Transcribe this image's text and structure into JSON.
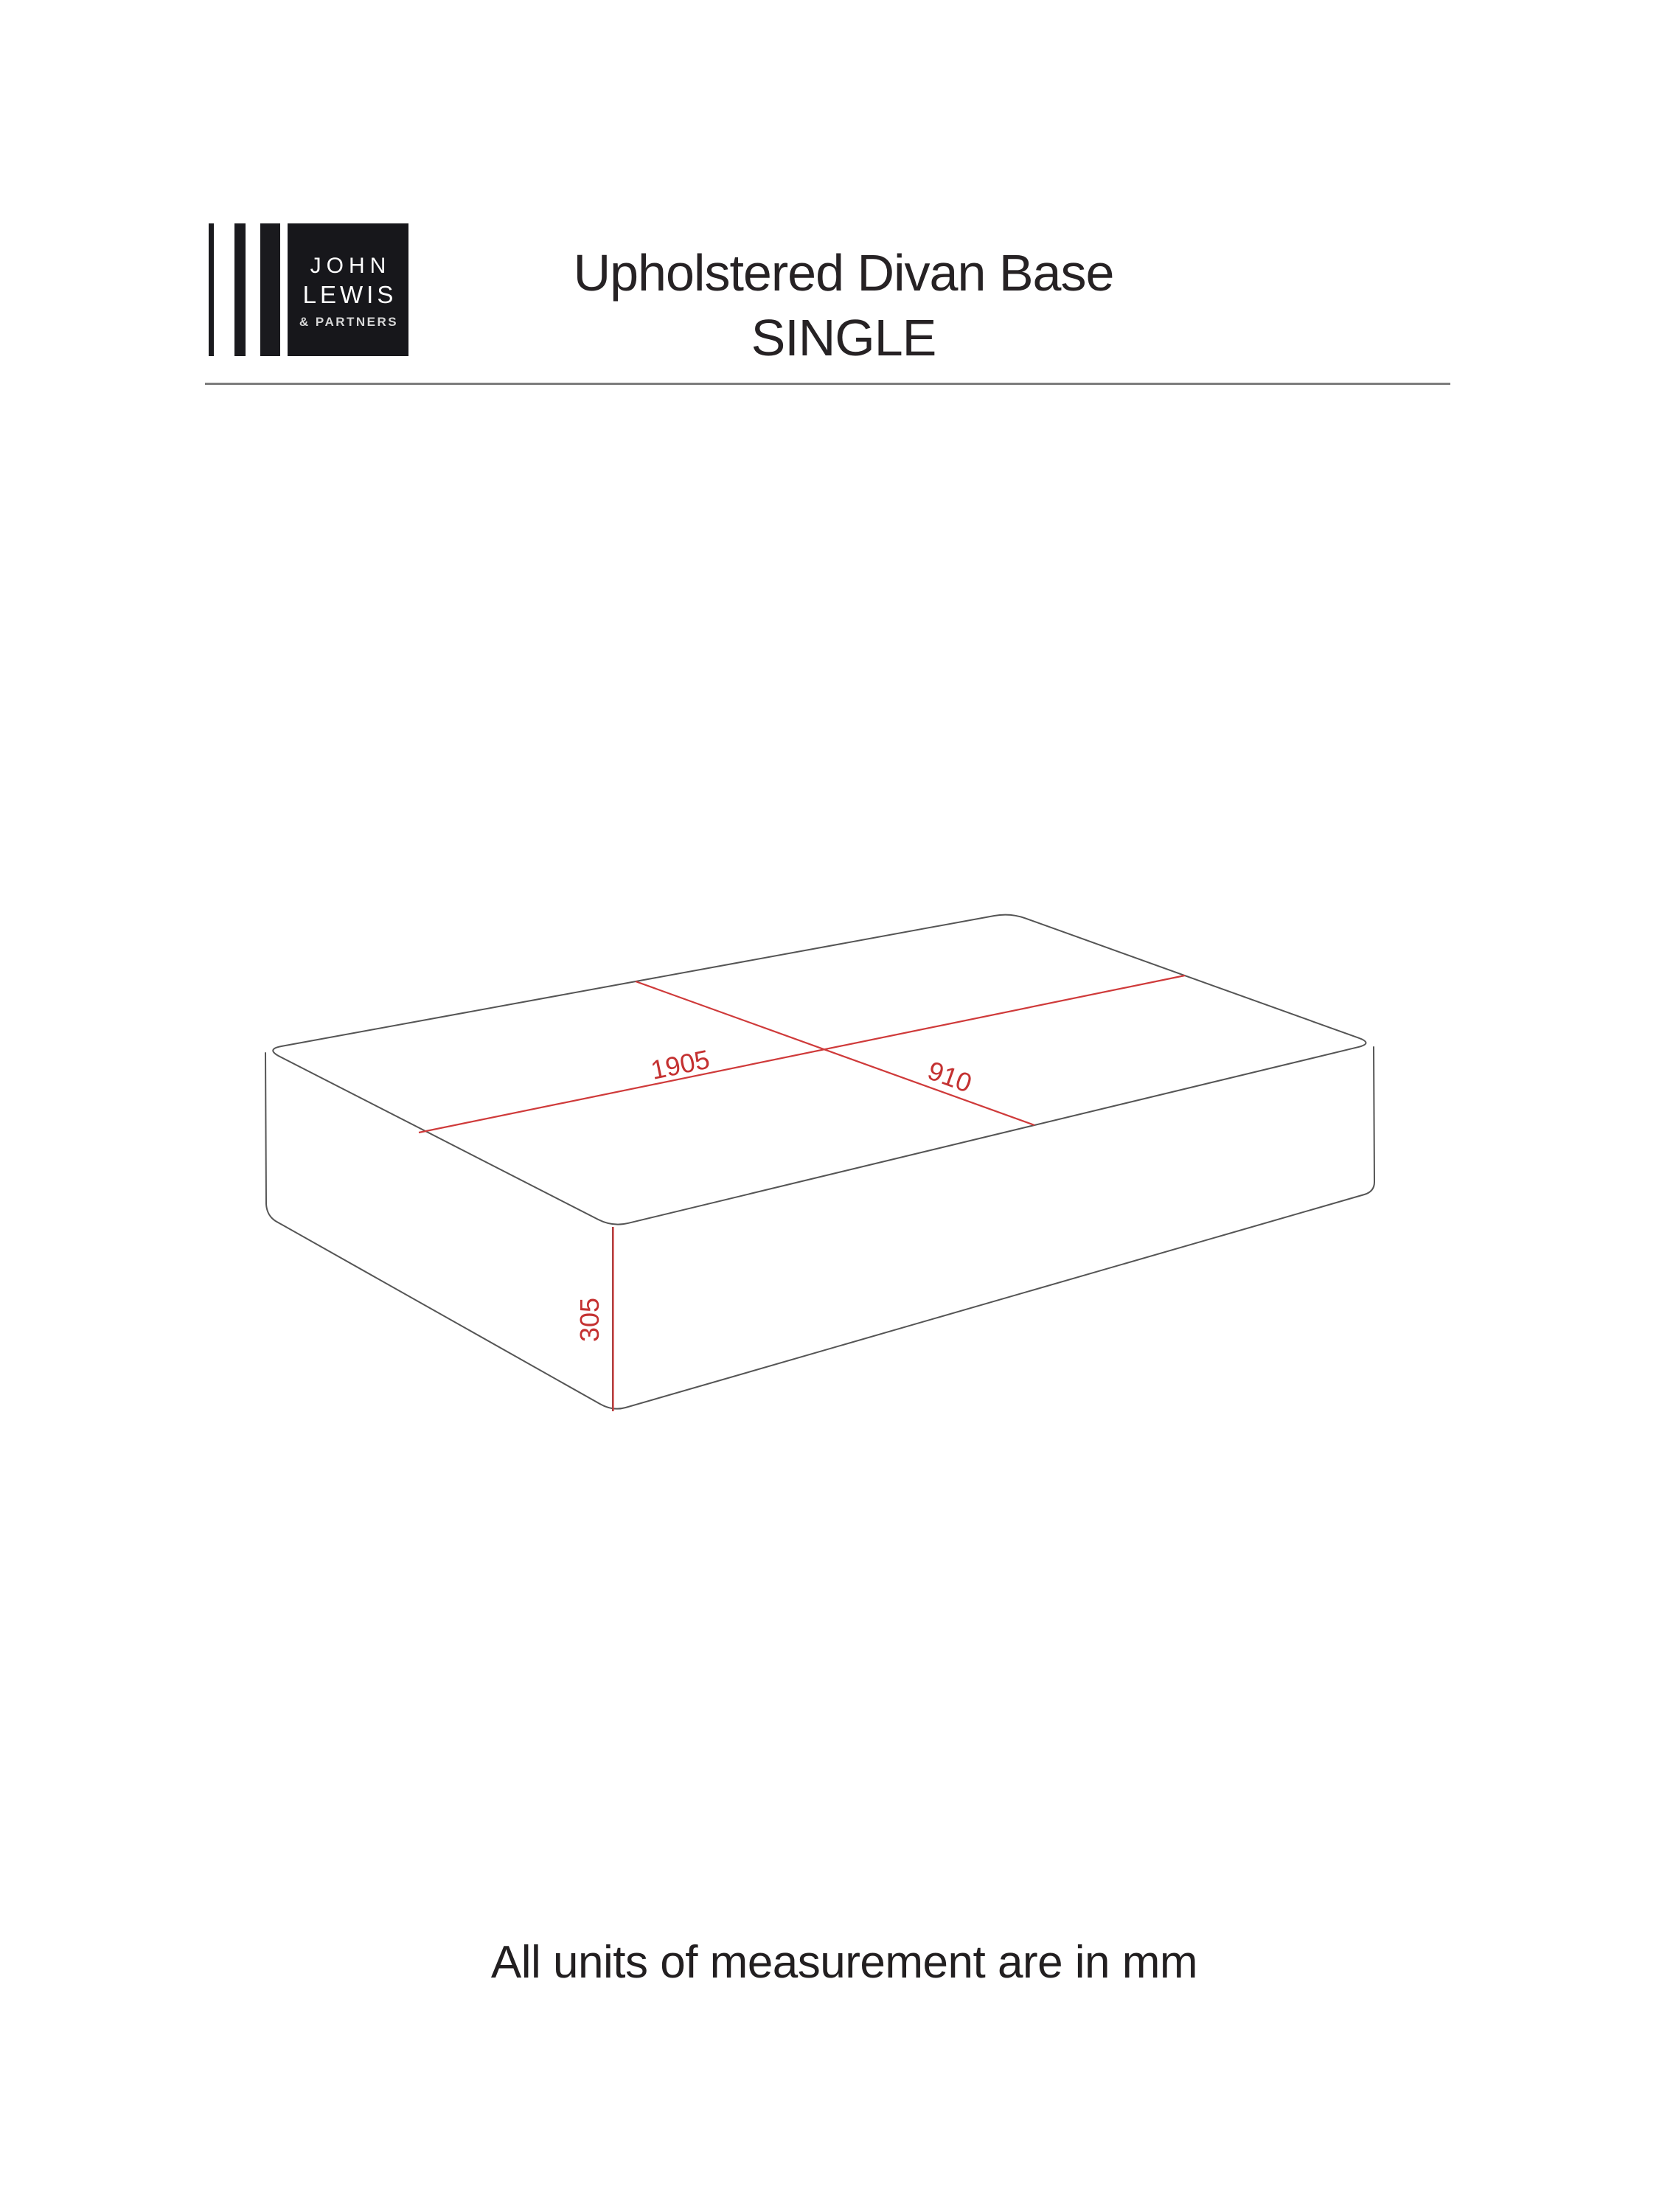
{
  "header": {
    "logo": {
      "word1": "JOHN",
      "word2": "LEWIS",
      "word3": "& PARTNERS"
    },
    "title_line1": "Upholstered Divan Base",
    "title_line2": "SINGLE"
  },
  "diagram": {
    "type": "isometric-divan-base-drawing",
    "dimensions": {
      "length_mm": "1905",
      "width_mm": "910",
      "height_mm": "305"
    },
    "colors": {
      "edge": "#555555",
      "dimension_line": "#cf3a3a",
      "dimension_text": "#c43131"
    }
  },
  "footer": {
    "note": "All units of measurement are in mm"
  }
}
